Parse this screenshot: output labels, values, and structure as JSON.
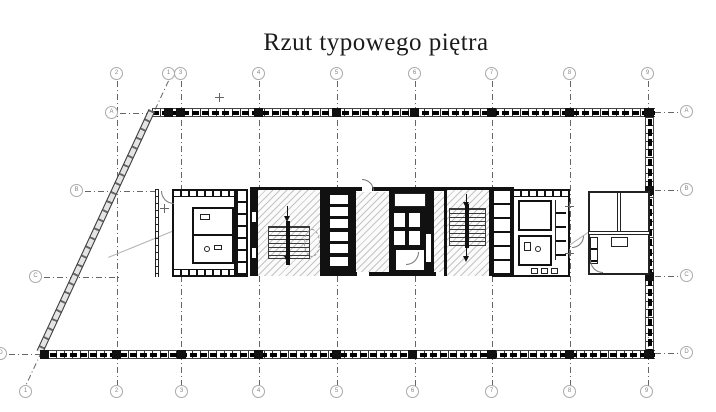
{
  "title": "Rzut typowego piętra",
  "grid": {
    "columns_top": [
      "2",
      "1",
      "3",
      "4",
      "5",
      "6",
      "7",
      "8",
      "9"
    ],
    "columns_bottom": [
      "1",
      "2",
      "3",
      "4",
      "5",
      "6",
      "7",
      "8",
      "9"
    ],
    "rows_left": [
      "A",
      "B",
      "C",
      "D"
    ],
    "rows_right": [
      "A",
      "B",
      "C",
      "D"
    ]
  },
  "colors": {
    "wall": "#111111",
    "grid_line": "#666666",
    "bubble_ring": "#aaaaaa",
    "hatch": "rgba(0,0,0,0.22)"
  }
}
